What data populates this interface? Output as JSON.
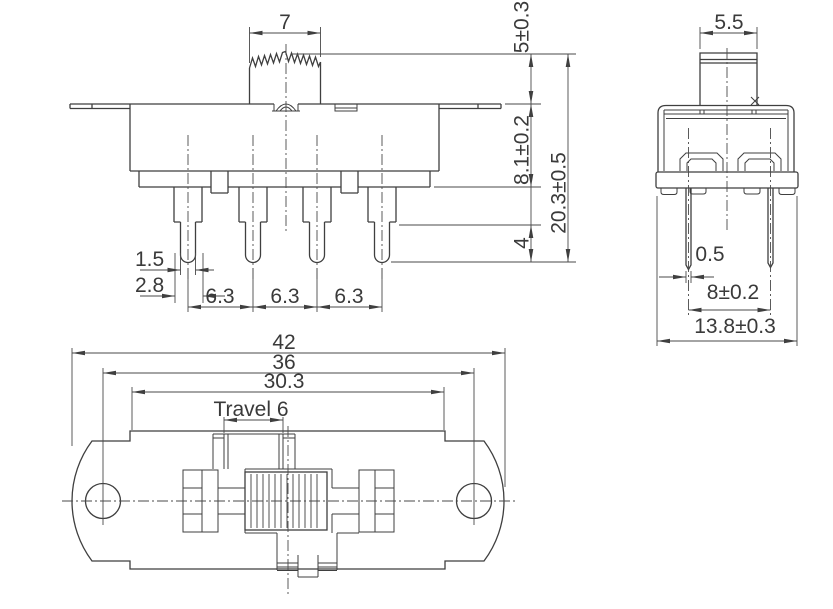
{
  "drawing": {
    "background": "#ffffff",
    "line_color": "#3f3f3f",
    "text_color": "#3a3a3a"
  },
  "labels": {
    "front": {
      "knob_width": "7",
      "knob_height": "5±0.3",
      "body_height": "8.1±0.2",
      "overall_height": "20.3±0.5",
      "pin_tip_length": "4",
      "pin_narrow_width": "1.5",
      "pin_wide_width": "2.8",
      "pin_pitch_12": "6.3",
      "pin_pitch_23": "6.3",
      "pin_pitch_34": "6.3"
    },
    "side": {
      "knob_width": "5.5",
      "pin_thickness": "0.5",
      "pin_row_spacing": "8±0.2",
      "overall_width": "13.8±0.3"
    },
    "top": {
      "overall_length": "42",
      "mounting_hole_spacing": "36",
      "frame_length": "30.3",
      "travel": "Travel 6"
    }
  }
}
